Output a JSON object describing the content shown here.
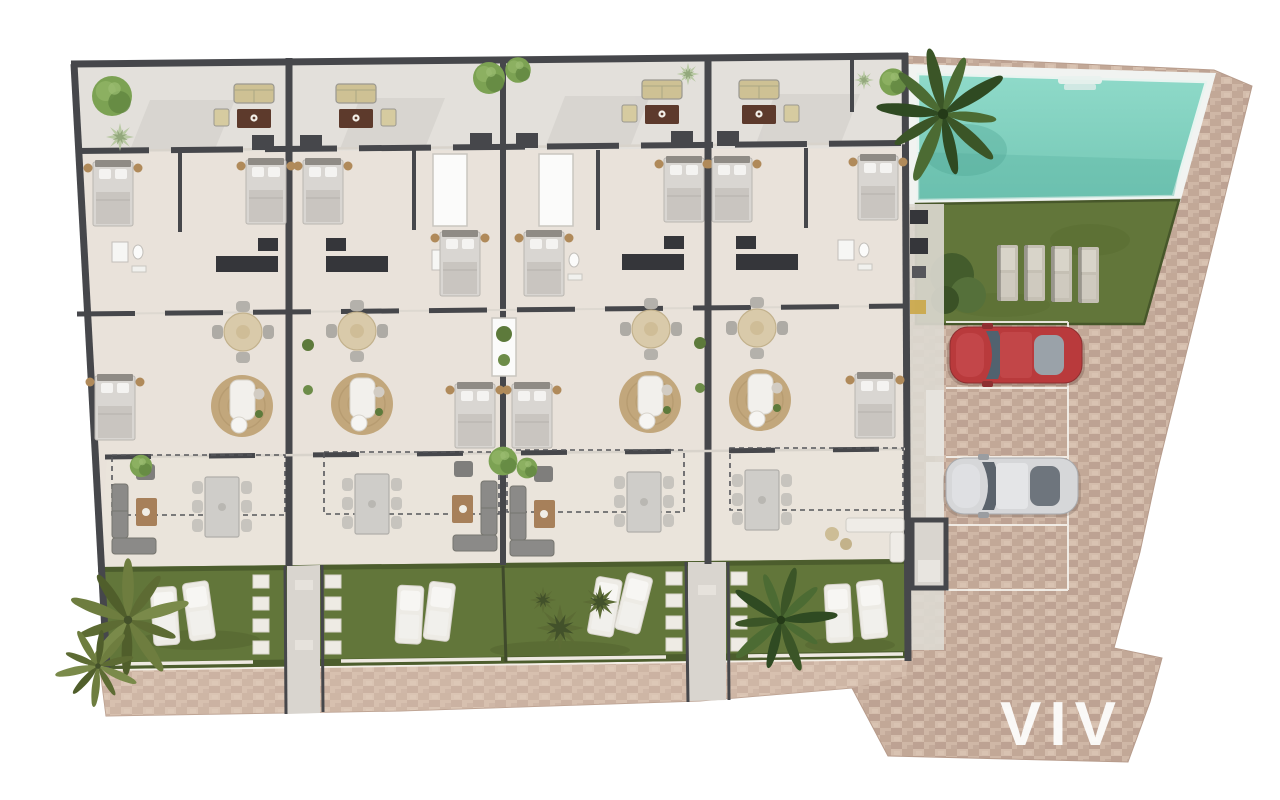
{
  "watermark": {
    "text": "VIV"
  },
  "palette": {
    "wall": "#46474b",
    "floor": "#e9e2da",
    "terraceTop": "#e3e0db",
    "terraceBottom": "#eae4db",
    "grass": "#62763a",
    "grassDark": "#47572a",
    "paving": "#c9b09f",
    "pavingLight": "#dcc7b6",
    "pool": "#86d4c3",
    "poolDeep": "#5fb7a4",
    "deck": "#f1f3f1",
    "concrete": "#d9d5cf",
    "rug": "#c2a77c",
    "sofaBeige": "#cec194",
    "tableWood": "#5d3a2c",
    "outdoorGray": "#8b8a88",
    "loungerWhite": "#edebe5",
    "redCar": "#b93a3c",
    "whiteCar": "#d6d7d9",
    "counter": "#35363a",
    "palmDark": "#3b5527",
    "palmOlive": "#6e7d3f",
    "treeGreen": "#7ca253",
    "watermark": "#fdfdfc"
  },
  "site": {
    "building_units": 4,
    "amenities": [
      "swimming-pool",
      "communal-lawn",
      "parking"
    ],
    "parking": {
      "bays": 4,
      "cars": [
        {
          "color_name": "red"
        },
        {
          "color_name": "white"
        }
      ]
    },
    "pools": 1,
    "lawn_sun_loungers": 4,
    "garden_sun_loungers": 8,
    "palm_trees": 4
  }
}
